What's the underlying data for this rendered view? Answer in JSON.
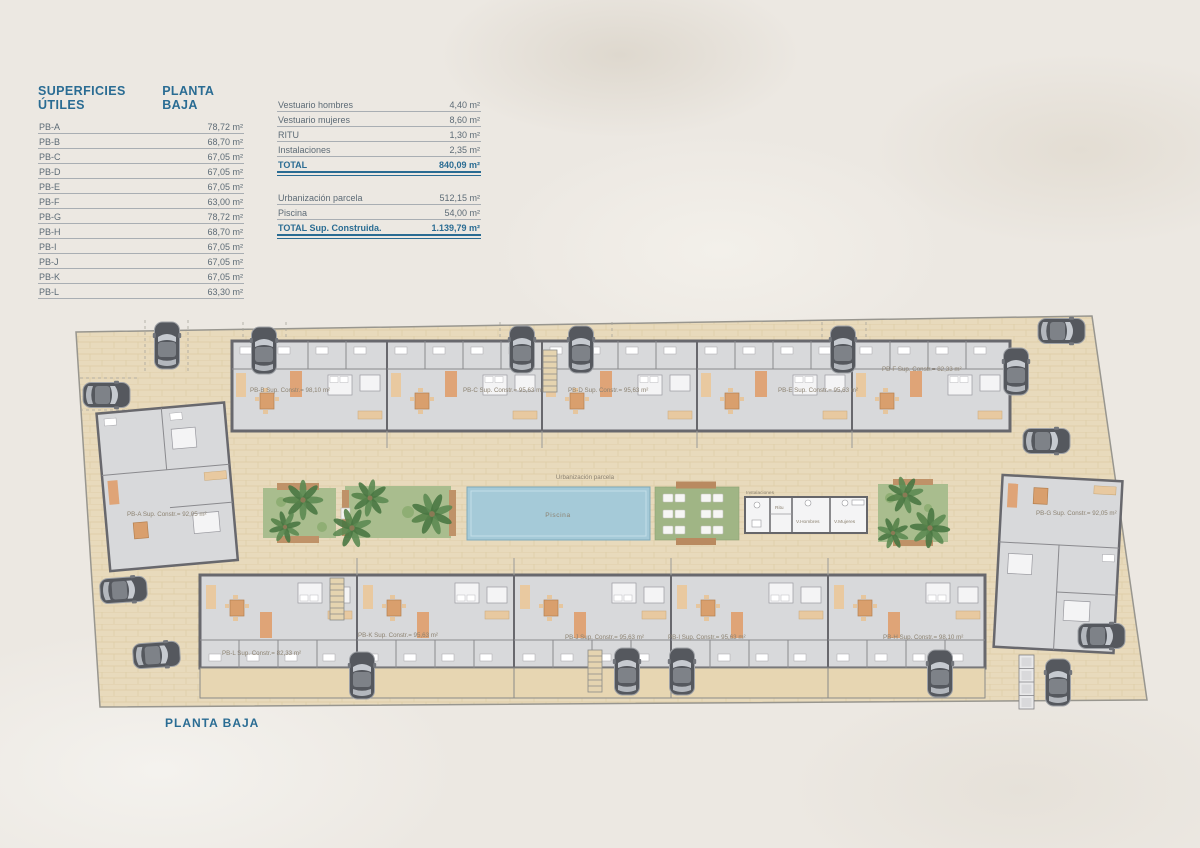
{
  "colors": {
    "accent_blue": "#2a6c93",
    "paving": "#e8dabc",
    "building_floor": "#d8d9db",
    "building_wall": "#68686d",
    "pool_blue": "#a5cad8",
    "garden_green": "#a9bd8e",
    "accent_orange": "#dfa477"
  },
  "legend": {
    "title": "SUPERFICIES ÚTILES",
    "subtitle": "PLANTA BAJA",
    "rows": [
      {
        "label": "PB-A",
        "value": "78,72 m²"
      },
      {
        "label": "PB-B",
        "value": "68,70 m²"
      },
      {
        "label": "PB-C",
        "value": "67,05 m²"
      },
      {
        "label": "PB-D",
        "value": "67,05 m²"
      },
      {
        "label": "PB-E",
        "value": "67,05 m²"
      },
      {
        "label": "PB-F",
        "value": "63,00 m²"
      },
      {
        "label": "PB-G",
        "value": "78,72 m²"
      },
      {
        "label": "PB-H",
        "value": "68,70 m²"
      },
      {
        "label": "PB-I",
        "value": "67,05 m²"
      },
      {
        "label": "PB-J",
        "value": "67,05 m²"
      },
      {
        "label": "PB-K",
        "value": "67,05 m²"
      },
      {
        "label": "PB-L",
        "value": "63,30 m²"
      }
    ]
  },
  "summary": {
    "rows_a": [
      {
        "label": "Vestuario hombres",
        "value": "4,40 m²"
      },
      {
        "label": "Vestuario mujeres",
        "value": "8,60 m²"
      },
      {
        "label": "RITU",
        "value": "1,30 m²"
      },
      {
        "label": "Instalaciones",
        "value": "2,35 m²"
      }
    ],
    "total_a": {
      "label": "TOTAL",
      "value": "840,09 m²"
    },
    "rows_b": [
      {
        "label": "Urbanización parcela",
        "value": "512,15 m²"
      },
      {
        "label": "Piscina",
        "value": "54,00 m²"
      }
    ],
    "total_b": {
      "label": "TOTAL Sup. Construida.",
      "value": "1.139,79 m²"
    }
  },
  "plan": {
    "caption": "PLANTA BAJA",
    "parcel_label": "Urbanización parcela",
    "pool_label": "Piscina",
    "facilities": {
      "instalaciones": "Instalaciones",
      "ritu": "Ritu",
      "v_hombres": "V.Hombres",
      "v_mujeres": "V.Mujeres"
    },
    "units": [
      {
        "id": "PB-A",
        "label": "PB-A Sup. Constr.= 92,05 m²"
      },
      {
        "id": "PB-B",
        "label": "PB-B Sup. Constr.= 98,10 m²"
      },
      {
        "id": "PB-C",
        "label": "PB-C Sup. Constr.= 95,63 m²"
      },
      {
        "id": "PB-D",
        "label": "PB-D Sup. Constr.= 95,63 m²"
      },
      {
        "id": "PB-E",
        "label": "PB-E Sup. Constr.= 95,63 m²"
      },
      {
        "id": "PB-F",
        "label": "PB-F Sup. Constr.= 82,33 m²"
      },
      {
        "id": "PB-G",
        "label": "PB-G Sup. Constr.= 92,05 m²"
      },
      {
        "id": "PB-H",
        "label": "PB-H Sup. Constr.= 98,10 m²"
      },
      {
        "id": "PB-I",
        "label": "PB-I Sup. Constr.= 95,63 m²"
      },
      {
        "id": "PB-J",
        "label": "PB-J Sup. Constr.= 95,63 m²"
      },
      {
        "id": "PB-K",
        "label": "PB-K Sup. Constr.= 95,63 m²"
      },
      {
        "id": "PB-L",
        "label": "PB-L Sup. Constr.= 82,33 m²"
      }
    ]
  }
}
